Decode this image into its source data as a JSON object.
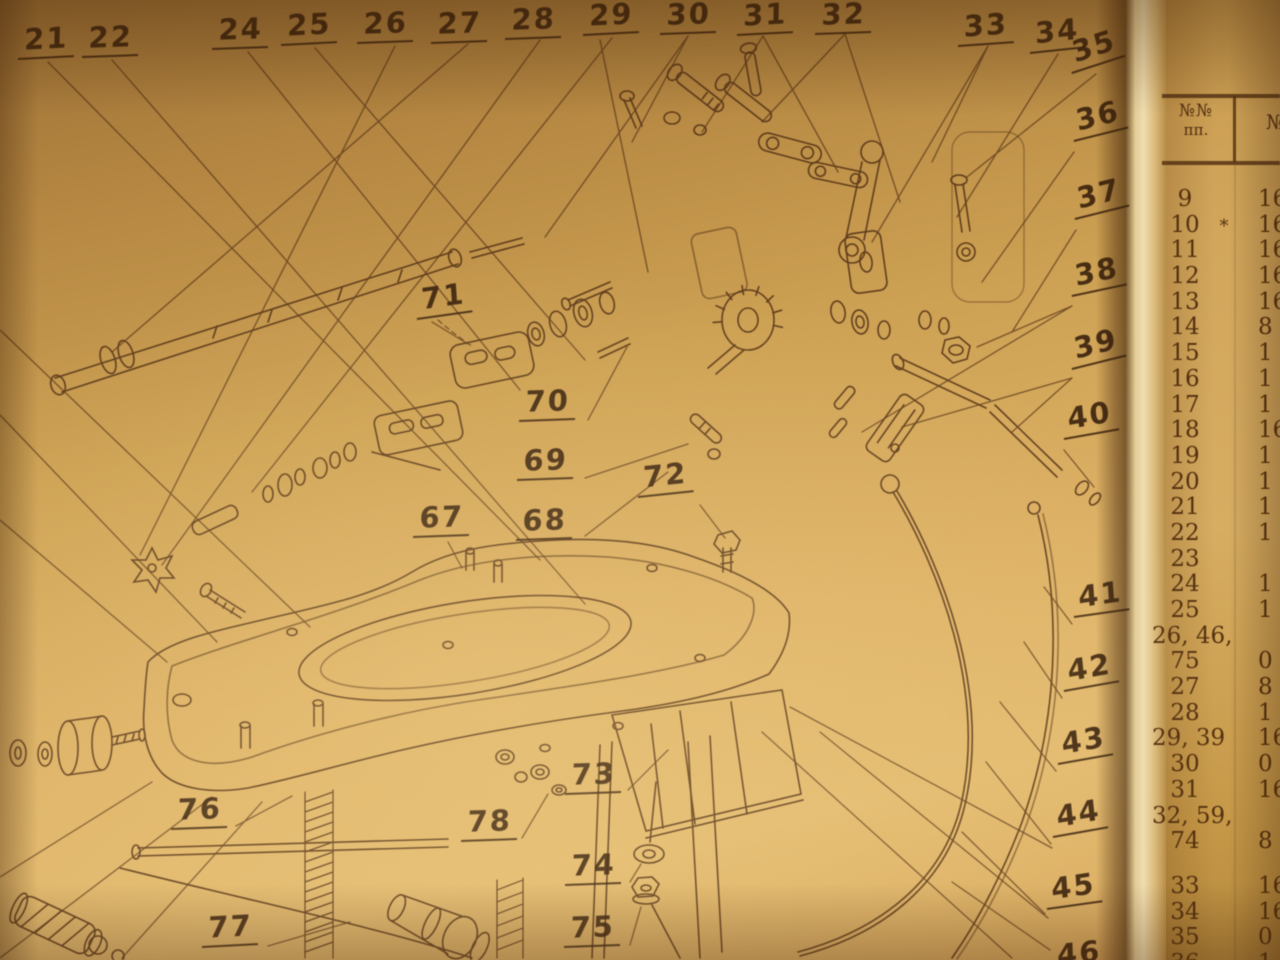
{
  "scene": {
    "kind": "photographed book page",
    "left_page": "exploded parts diagram with numbered callouts",
    "right_page_fragment": "parts list table, left columns only visible"
  },
  "diagram": {
    "callouts": [
      {
        "label": "21",
        "x": 18,
        "y": 26,
        "rot": -3
      },
      {
        "label": "22",
        "x": 82,
        "y": 24,
        "rot": -2
      },
      {
        "label": "24",
        "x": 212,
        "y": 16,
        "rot": -2
      },
      {
        "label": "25",
        "x": 281,
        "y": 12,
        "rot": -3
      },
      {
        "label": "26",
        "x": 357,
        "y": 10,
        "rot": -2
      },
      {
        "label": "27",
        "x": 431,
        "y": 10,
        "rot": -2
      },
      {
        "label": "28",
        "x": 505,
        "y": 6,
        "rot": -2
      },
      {
        "label": "29",
        "x": 583,
        "y": 2,
        "rot": -3
      },
      {
        "label": "30",
        "x": 660,
        "y": 1,
        "rot": -2
      },
      {
        "label": "31",
        "x": 737,
        "y": 2,
        "rot": -3
      },
      {
        "label": "32",
        "x": 815,
        "y": 1,
        "rot": -2
      },
      {
        "label": "33",
        "x": 958,
        "y": 13,
        "rot": -4
      },
      {
        "label": "34",
        "x": 1030,
        "y": 20,
        "rot": -6
      },
      {
        "label": "35",
        "x": 1072,
        "y": 40,
        "rot": -18
      },
      {
        "label": "36",
        "x": 1074,
        "y": 108,
        "rot": -14
      },
      {
        "label": "37",
        "x": 1075,
        "y": 186,
        "rot": -14
      },
      {
        "label": "38",
        "x": 1072,
        "y": 263,
        "rot": -12
      },
      {
        "label": "39",
        "x": 1072,
        "y": 336,
        "rot": -14
      },
      {
        "label": "40",
        "x": 1064,
        "y": 406,
        "rot": -10
      },
      {
        "label": "41",
        "x": 1074,
        "y": 584,
        "rot": -8
      },
      {
        "label": "42",
        "x": 1064,
        "y": 658,
        "rot": -10
      },
      {
        "label": "43",
        "x": 1058,
        "y": 731,
        "rot": -10
      },
      {
        "label": "44",
        "x": 1053,
        "y": 804,
        "rot": -10
      },
      {
        "label": "45",
        "x": 1047,
        "y": 876,
        "rot": -8
      },
      {
        "label": "46",
        "x": 1052,
        "y": 942,
        "rot": -6
      },
      {
        "label": "71",
        "x": 417,
        "y": 286,
        "rot": -8
      },
      {
        "label": "70",
        "x": 519,
        "y": 388,
        "rot": -2
      },
      {
        "label": "69",
        "x": 517,
        "y": 447,
        "rot": -2
      },
      {
        "label": "67",
        "x": 413,
        "y": 504,
        "rot": -2
      },
      {
        "label": "68",
        "x": 516,
        "y": 507,
        "rot": -2
      },
      {
        "label": "72",
        "x": 638,
        "y": 464,
        "rot": -6
      },
      {
        "label": "73",
        "x": 565,
        "y": 761,
        "rot": -2
      },
      {
        "label": "78",
        "x": 461,
        "y": 808,
        "rot": -2
      },
      {
        "label": "74",
        "x": 565,
        "y": 852,
        "rot": -2
      },
      {
        "label": "75",
        "x": 564,
        "y": 914,
        "rot": -2
      },
      {
        "label": "76",
        "x": 171,
        "y": 796,
        "rot": -2
      },
      {
        "label": "77",
        "x": 202,
        "y": 914,
        "rot": -3
      }
    ]
  },
  "table": {
    "header": {
      "col1_line1": "№№",
      "col1_line2": "пп.",
      "col2_fragment": "№"
    },
    "rows": [
      {
        "no": "9",
        "frag": "16"
      },
      {
        "no": "10",
        "frag": "16",
        "star": true
      },
      {
        "no": "11",
        "frag": "16"
      },
      {
        "no": "12",
        "frag": "16"
      },
      {
        "no": "13",
        "frag": "16"
      },
      {
        "no": "14",
        "frag": "8"
      },
      {
        "no": "15",
        "frag": "1"
      },
      {
        "no": "16",
        "frag": "1"
      },
      {
        "no": "17",
        "frag": "1"
      },
      {
        "no": "18",
        "frag": "16"
      },
      {
        "no": "19",
        "frag": "1"
      },
      {
        "no": "20",
        "frag": "1"
      },
      {
        "no": "21",
        "frag": "1"
      },
      {
        "no": "22",
        "frag": "1"
      },
      {
        "no": "23",
        "frag": ""
      },
      {
        "no": "24",
        "frag": "1"
      },
      {
        "no": "25",
        "frag": "1"
      },
      {
        "no": "26, 46,",
        "frag": ""
      },
      {
        "no": "75",
        "frag": "0"
      },
      {
        "no": "27",
        "frag": "8"
      },
      {
        "no": "28",
        "frag": "1"
      },
      {
        "no": "29, 39",
        "frag": "16"
      },
      {
        "no": "30",
        "frag": "0"
      },
      {
        "no": "31",
        "frag": "16"
      },
      {
        "no": "32, 59,",
        "frag": ""
      },
      {
        "no": "74",
        "frag": "8"
      },
      {
        "no": "33",
        "frag": "16",
        "gap_before": true
      },
      {
        "no": "34",
        "frag": "16"
      },
      {
        "no": "35",
        "frag": "0"
      },
      {
        "no": "36",
        "frag": "1"
      }
    ]
  },
  "colors": {
    "paper_light": "#e3bb70",
    "paper_dark": "#9d7136",
    "ink": "#4f2d13",
    "table_ink": "#53300f"
  }
}
